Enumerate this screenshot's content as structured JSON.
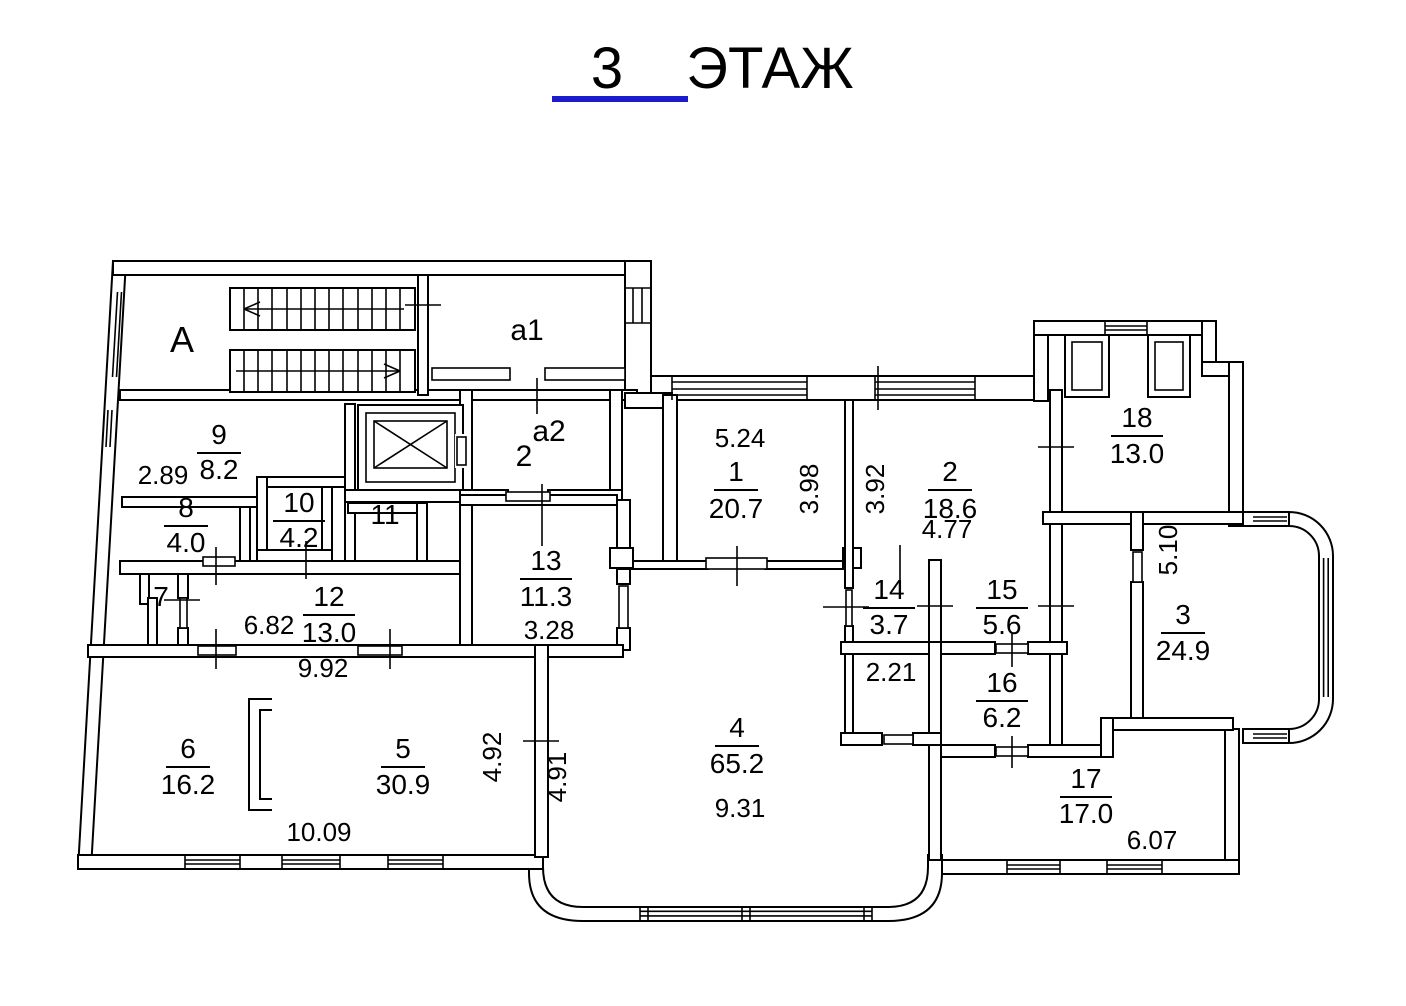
{
  "title": {
    "number": "3",
    "word": "ЭТАЖ"
  },
  "colors": {
    "ink": "#000000",
    "title": "#1c1ccd",
    "accent": "#e8372a"
  },
  "labels": {
    "stairwell": "A",
    "balcony1": "a1",
    "balcony2": "a2",
    "balcony2_flat": "2"
  },
  "rooms": [
    {
      "number": "1",
      "area": "20.7"
    },
    {
      "number": "2",
      "area": "18.6"
    },
    {
      "number": "3",
      "area": "24.9"
    },
    {
      "number": "4",
      "area": "65.2"
    },
    {
      "number": "5",
      "area": "30.9"
    },
    {
      "number": "6",
      "area": "16.2"
    },
    {
      "number": "7",
      "area": ""
    },
    {
      "number": "8",
      "area": "4.0"
    },
    {
      "number": "9",
      "area": "8.2"
    },
    {
      "number": "10",
      "area": "4.2"
    },
    {
      "number": "11",
      "area": ""
    },
    {
      "number": "12",
      "area": "13.0"
    },
    {
      "number": "13",
      "area": "11.3"
    },
    {
      "number": "14",
      "area": "3.7"
    },
    {
      "number": "15",
      "area": "5.6"
    },
    {
      "number": "16",
      "area": "6.2"
    },
    {
      "number": "17",
      "area": "17.0"
    },
    {
      "number": "18",
      "area": "13.0"
    }
  ],
  "dims": {
    "room1_top": "5.24",
    "room1_right": "3.98",
    "room2_left": "3.92",
    "room2_bottom": "4.77",
    "room9_left": "2.89",
    "room12_bottom": "6.82",
    "corridor_bottom": "9.92",
    "room13_bottom": "3.28",
    "room5_bottom": "10.09",
    "room5_right": "4.92",
    "room4_left": "4.91",
    "room4_bottom": "9.31",
    "hall_top": "2.21",
    "room3_left": "5.10",
    "room17_bottom": "6.07"
  }
}
